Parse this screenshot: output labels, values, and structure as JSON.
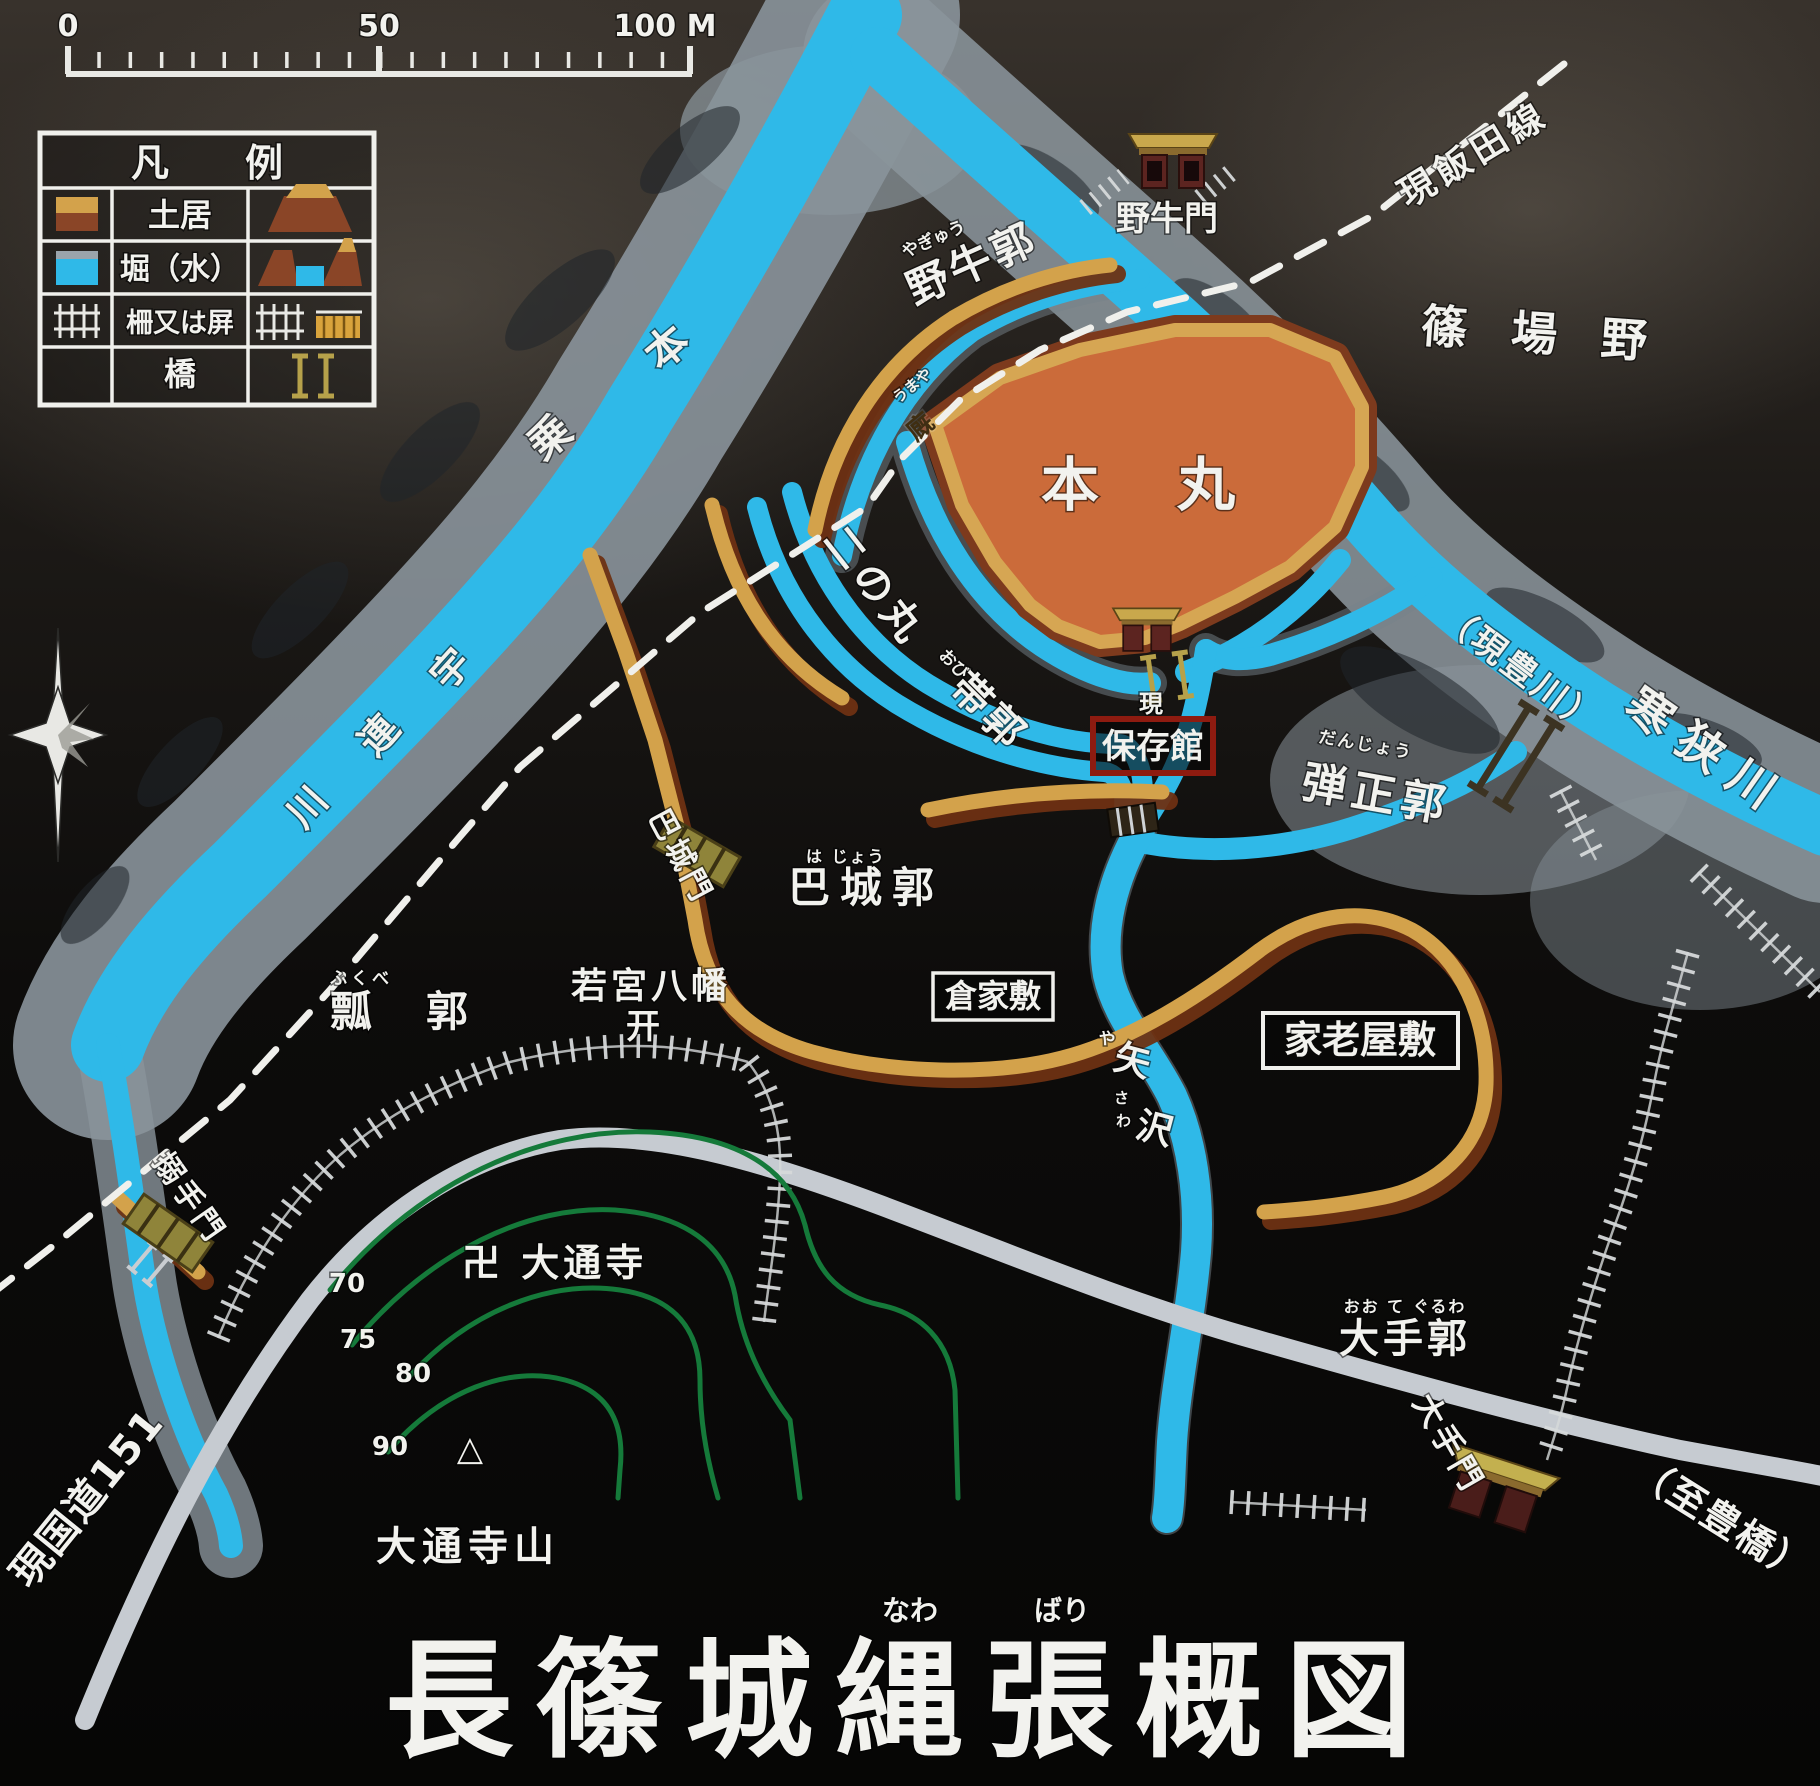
{
  "sign": {
    "title": "長篠城縄張概図",
    "title_furigana": {
      "nawa": "なわ",
      "bari": "ばり"
    }
  },
  "scale_bar": {
    "t0": "0",
    "t50": "50",
    "t100": "100 M"
  },
  "legend": {
    "header": "凡　　例",
    "rows": [
      {
        "label": "土居"
      },
      {
        "label": "堀（水）"
      },
      {
        "label": "柵又は屏"
      },
      {
        "label": "橋"
      }
    ]
  },
  "labels": {
    "yagyumon": {
      "t": "野牛門"
    },
    "yagyukuruwa": {
      "t": "野牛郭",
      "f": "やぎゅう"
    },
    "umaya": {
      "t": "廐",
      "f": "うまや"
    },
    "honmaru": {
      "t": "本　丸"
    },
    "ninomaru": {
      "t": "二の丸"
    },
    "obikuruwa": {
      "t": "帯郭",
      "f": "おび"
    },
    "gen": {
      "t": "現"
    },
    "hozonkan": {
      "t": "保存館"
    },
    "danjokuruwa": {
      "t": "弾正郭",
      "f": "だんじょう"
    },
    "hajomon": {
      "t": "巴城門"
    },
    "hajokuruwa": {
      "t": "巴城郭",
      "f": "は じょう"
    },
    "kurayashiki": {
      "t": "倉家敷"
    },
    "karoyashiki": {
      "t": "家老屋敷"
    },
    "fukubekuruwa": {
      "t": "瓢　郭",
      "f": "ふくべ"
    },
    "wakamiya": {
      "t": "若宮八幡",
      "torii": "开"
    },
    "karametemon": {
      "t": "搦手門"
    },
    "otekuruwa": {
      "t": "大手郭",
      "f": "おお て ぐるわ"
    },
    "otemon": {
      "t": "大手門"
    },
    "totoyohashi": {
      "t": "（至豊橋）"
    },
    "norimoto": {
      "c0": "乗",
      "c1": "本"
    },
    "shinobano": {
      "t": "篠 場 野"
    },
    "iidasen": {
      "t": "現飯田線"
    },
    "kokudo151": {
      "t": "現国道151"
    },
    "urekawa": {
      "c0": "宇",
      "c1": "連",
      "c2": "川"
    },
    "gentoyokawa": {
      "t": "（現豊川）"
    },
    "kansagawa": {
      "t": "寒狭川"
    },
    "yazawa": {
      "c0": "矢",
      "c1": "沢",
      "f0": "や",
      "f1": "さ",
      "f2": "わ"
    },
    "daitsuji": {
      "t": "卍 大通寺"
    },
    "daitsujiyama": {
      "t": "大通寺山"
    },
    "summit": {
      "t": "△"
    },
    "contours": {
      "l70": "70",
      "l75": "75",
      "l80": "80",
      "l90": "90"
    }
  },
  "colors": {
    "water": "#2fb9e8",
    "bank_gray": "#8a949b",
    "earth_tan": "#d3a24b",
    "earth_brown": "#8a4527",
    "honmaru_fill": "#cb6b3a",
    "contour_green": "#157a3a",
    "road_gray": "#c6cbd1",
    "label_white": "#f2f2ee",
    "hozonkan_red": "#8e1b10",
    "background": "#0b0a09"
  }
}
